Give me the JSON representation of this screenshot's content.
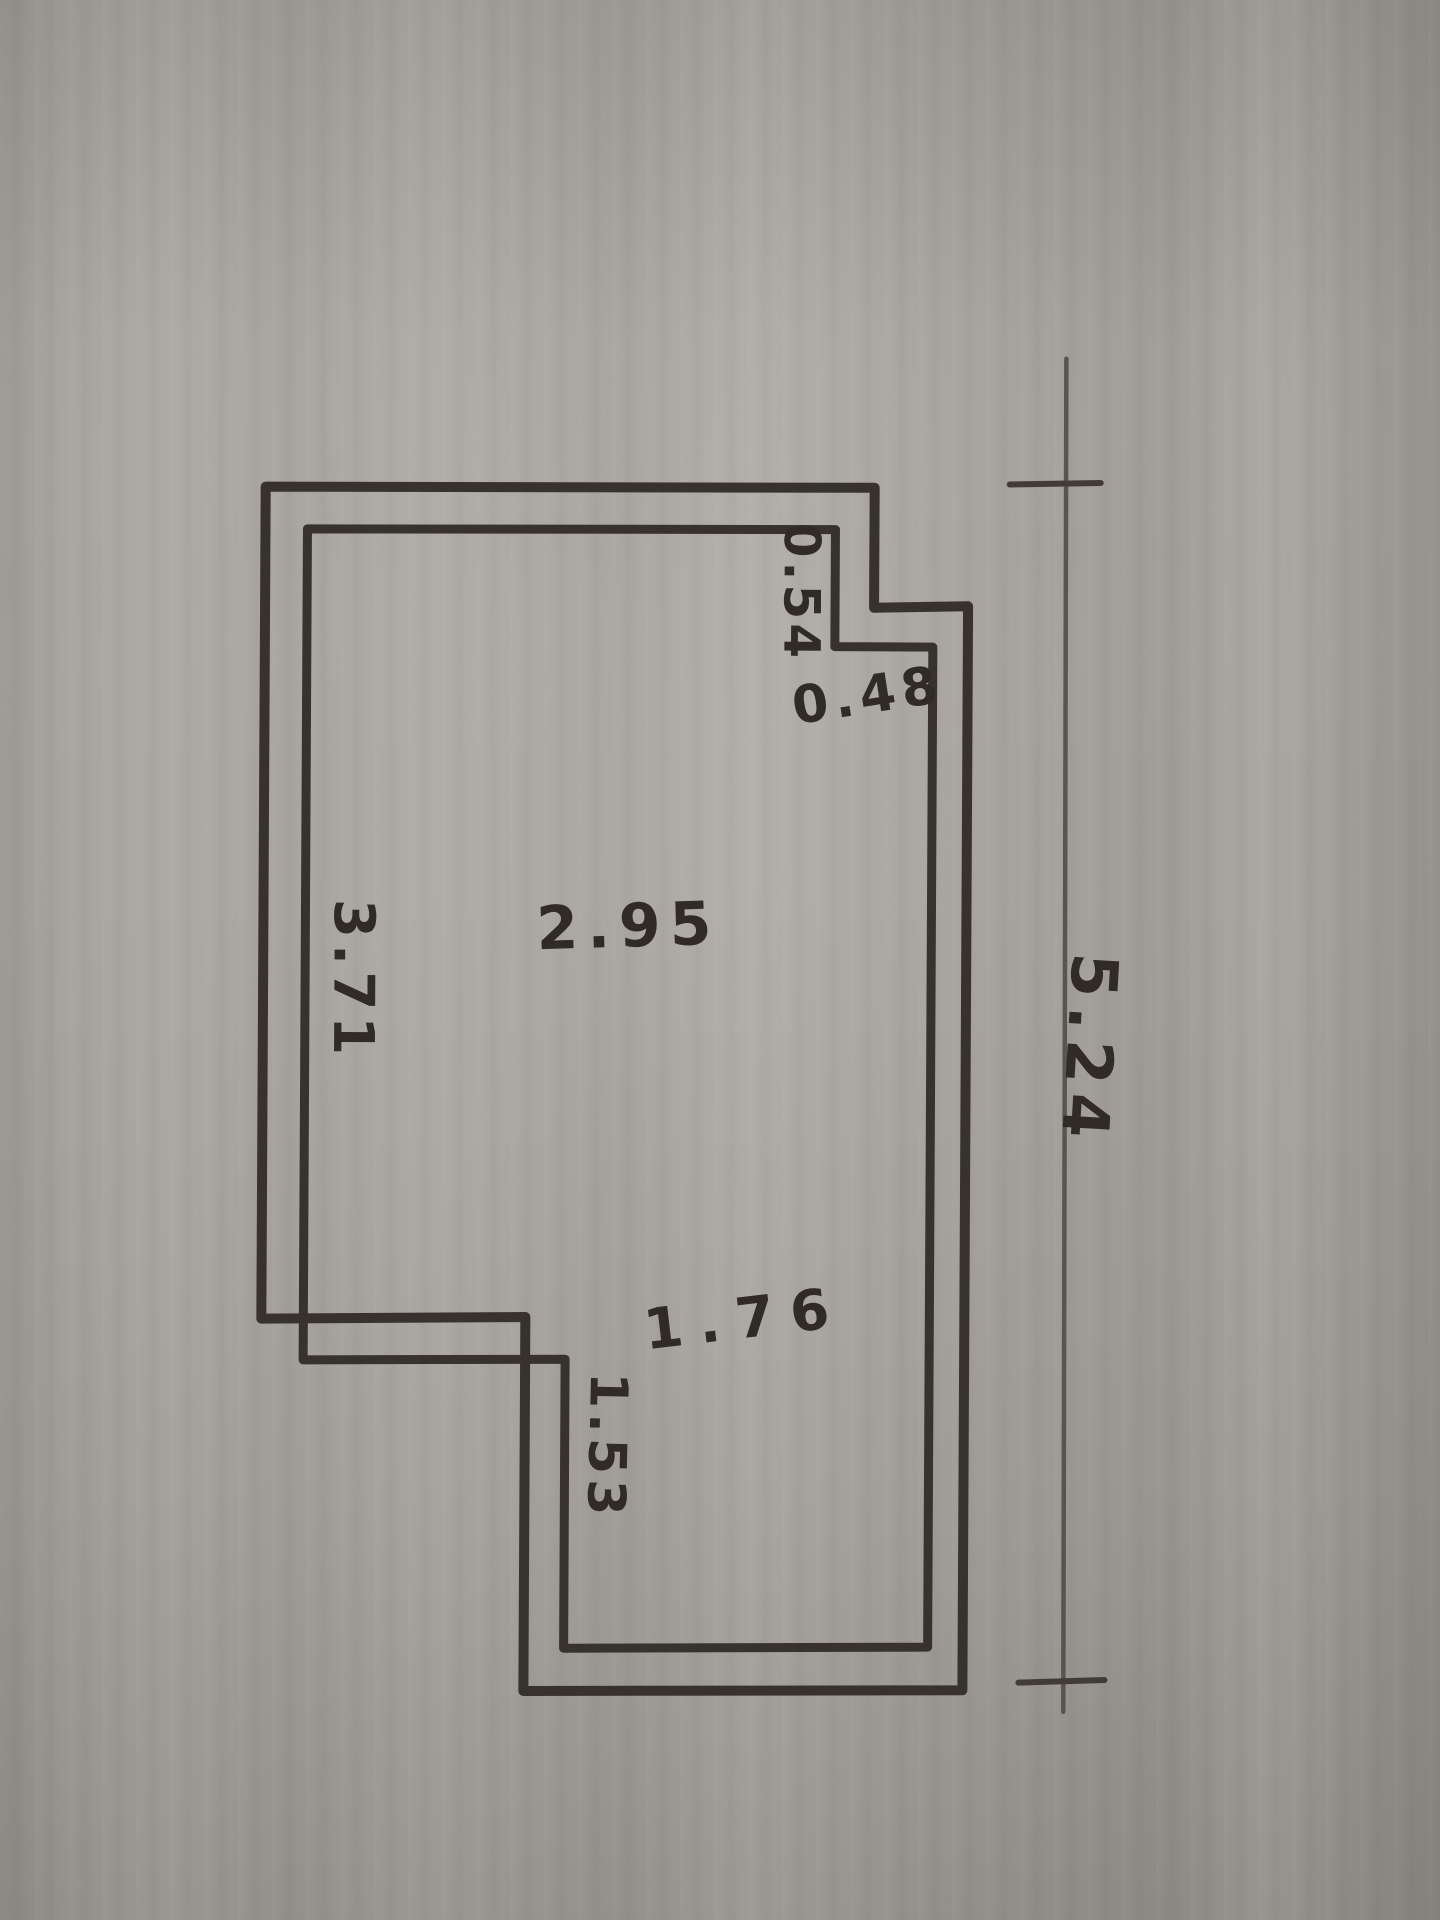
{
  "scene": {
    "description": "Photographed hand-drawn floor plan sketch in black ink on gray paper",
    "paper_color": "#b3afa9",
    "ink_color": "#3b352f",
    "pencil_color": "#5a544d"
  },
  "plan": {
    "labels": {
      "notch_side": "0.54",
      "notch_bottom": "0.48",
      "room_width": "2.95",
      "left_wall_height": "3.71",
      "overall_right_height": "5.24",
      "lower_section_width": "1.76",
      "step_wall_height": "1.53"
    }
  }
}
